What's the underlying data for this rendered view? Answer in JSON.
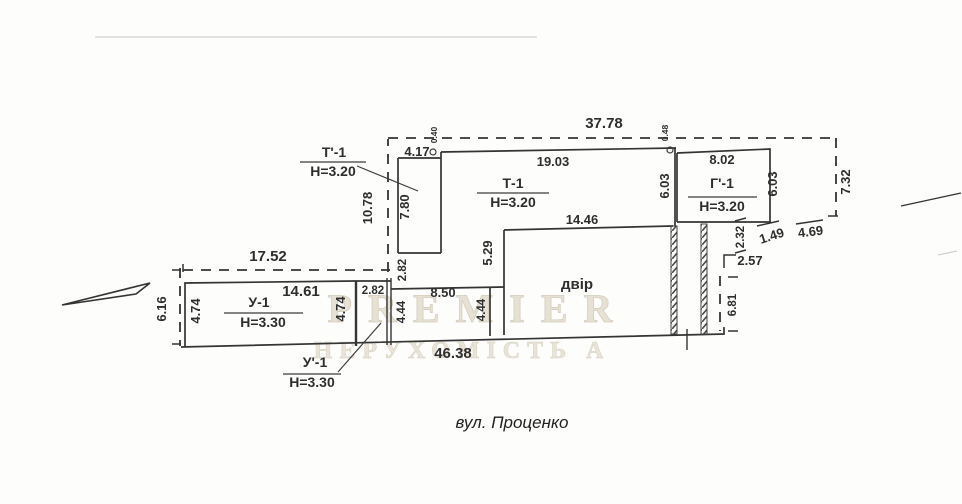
{
  "street_label": "вул. Проценко",
  "watermark": {
    "line1": "PREMIER",
    "line2": "НЕРУХОМІСТЬ А"
  },
  "rooms": {
    "t1_annex": {
      "name": "Т'-1",
      "height": "Н=3.20"
    },
    "t1": {
      "name": "Т-1",
      "height": "Н=3.20"
    },
    "g1": {
      "name": "Г'-1",
      "height": "Н=3.20"
    },
    "u1": {
      "name": "У-1",
      "height": "Н=3.30"
    },
    "u1_annex": {
      "name": "У'-1",
      "height": "Н=3.30"
    },
    "courtyard": {
      "name": "двір"
    }
  },
  "dims": {
    "boundary_top": "37.78",
    "boundary_left": "17.52",
    "boundary_left_height": "6.16",
    "boundary_mid_height": "10.78",
    "boundary_right_height": "7.32",
    "offset_top_left": "0.40",
    "offset_top_right": "0.48",
    "t1_top": "19.03",
    "t1_annex_offset": "4.17",
    "t1_annex_depth": "7.80",
    "t1_annex_gap": "2.82",
    "u1_gap_width": "2.82",
    "u1_width": "14.61",
    "u1_depth_left": "4.74",
    "u1_depth_right": "4.74",
    "u2_width": "8.50",
    "u2_depth_left": "4.44",
    "u2_depth_right": "4.44",
    "court_left": "5.29",
    "court_top": "14.46",
    "street_total": "46.38",
    "g1_left": "6.03",
    "g1_right": "6.03",
    "g1_top": "8.02",
    "right_232": "2.32",
    "right_149": "1.49",
    "right_469": "4.69",
    "right_257": "2.57",
    "right_681": "6.81"
  }
}
